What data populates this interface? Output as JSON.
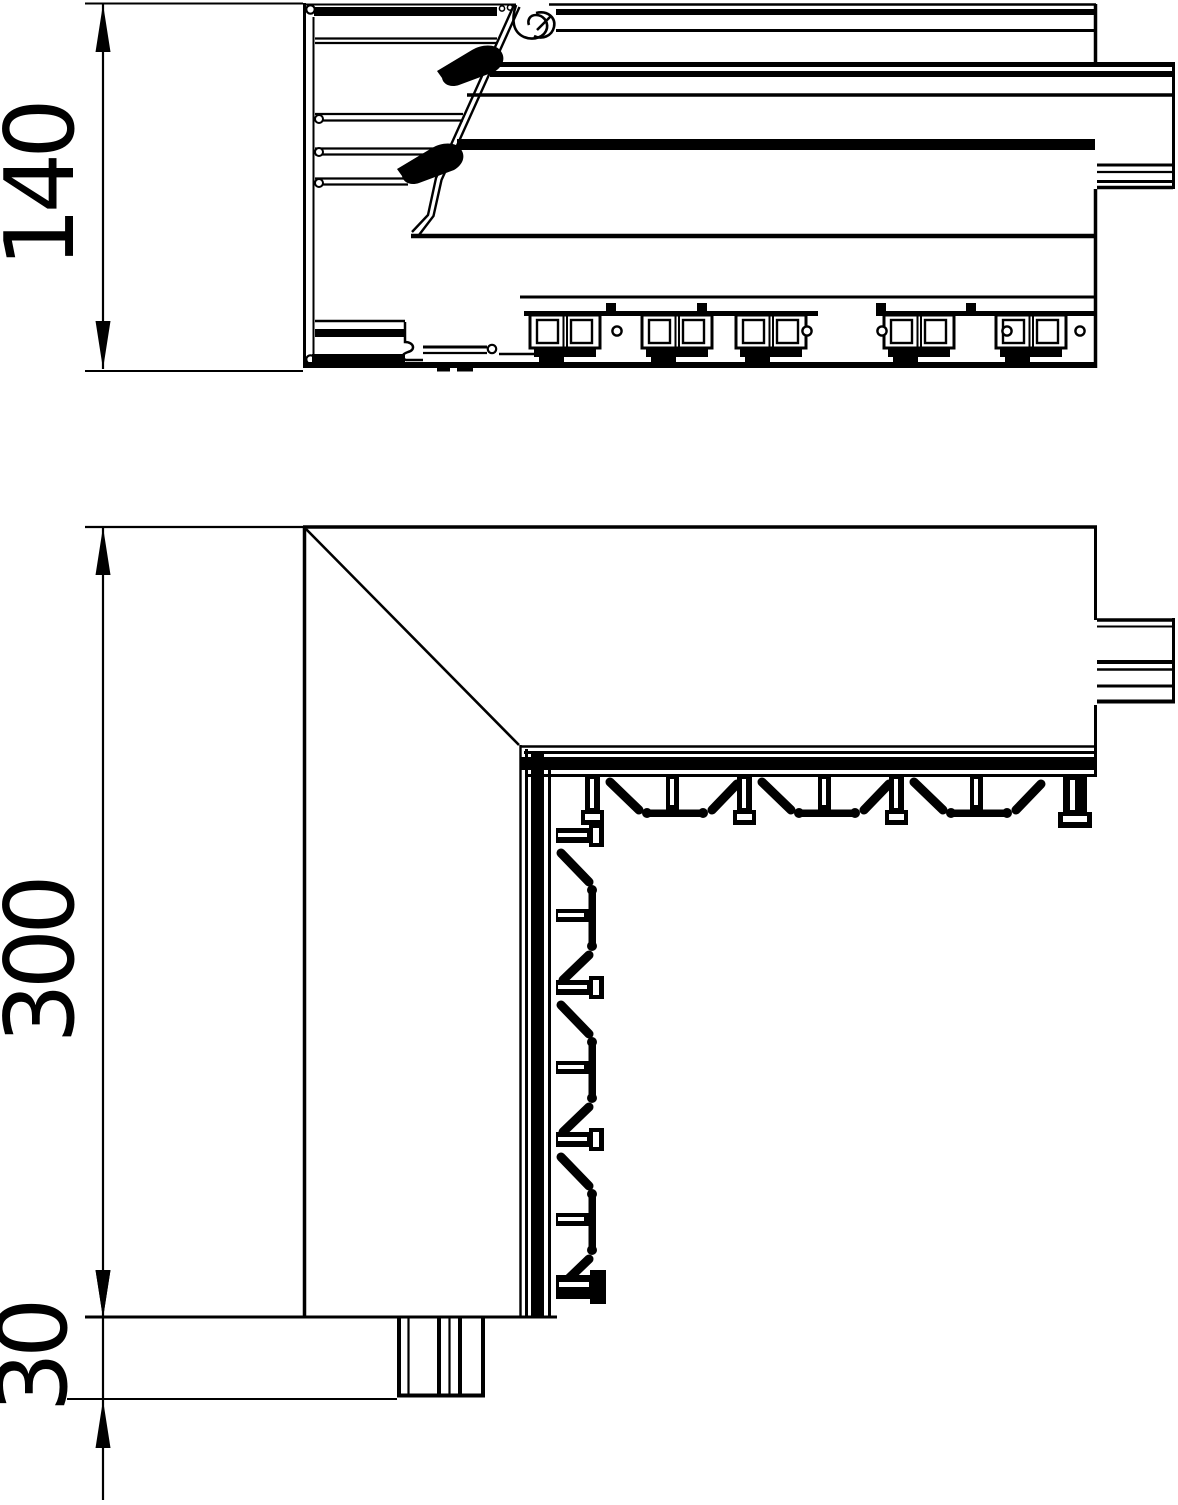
{
  "drawing": {
    "type": "technical-drawing",
    "subject": "cable-trunking-internal-corner",
    "views": [
      {
        "id": "section-view",
        "description": "profile cross-section"
      },
      {
        "id": "plan-view",
        "description": "corner plan view"
      }
    ],
    "dimensions": [
      {
        "id": "dim-140",
        "label": "140",
        "orientation": "vertical",
        "view": "section-view"
      },
      {
        "id": "dim-300",
        "label": "300",
        "orientation": "vertical",
        "view": "plan-view"
      },
      {
        "id": "dim-30",
        "label": "30",
        "orientation": "vertical",
        "view": "plan-view"
      }
    ],
    "colors": {
      "line": "#000000",
      "background": "#ffffff"
    }
  }
}
